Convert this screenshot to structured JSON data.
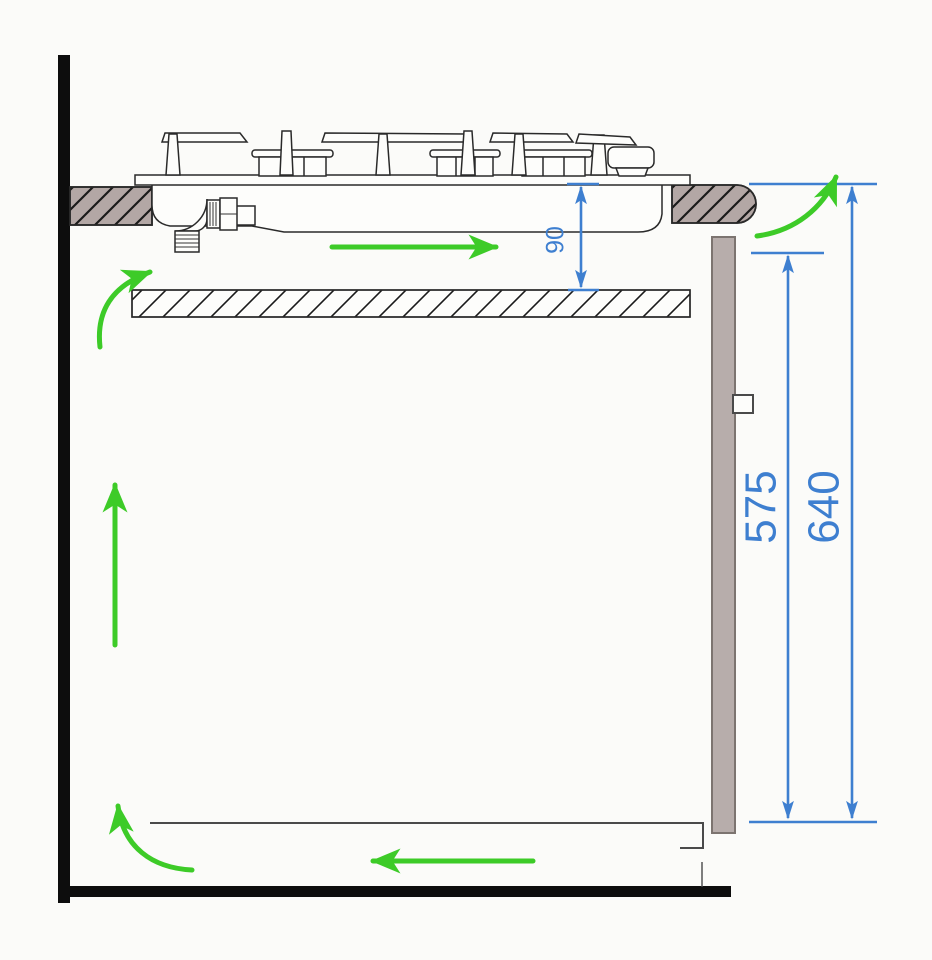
{
  "dimensions": {
    "hob_bottom_to_shelf": "90",
    "side_panel_height": "575",
    "worktop_top_height": "640"
  },
  "colors": {
    "dimension_blue": "#3e7fd0",
    "airflow_green": "#3dcb28",
    "worktop_fill": "#b3a7a5",
    "panel_fill": "#b7adab",
    "line_dark": "#2a2a2a",
    "wall_black": "#0d0d0d",
    "background": "#fbfbf9"
  },
  "icons": {
    "airflow_arrow": "green-arrow",
    "dimension_arrow": "blue-double-arrow"
  }
}
